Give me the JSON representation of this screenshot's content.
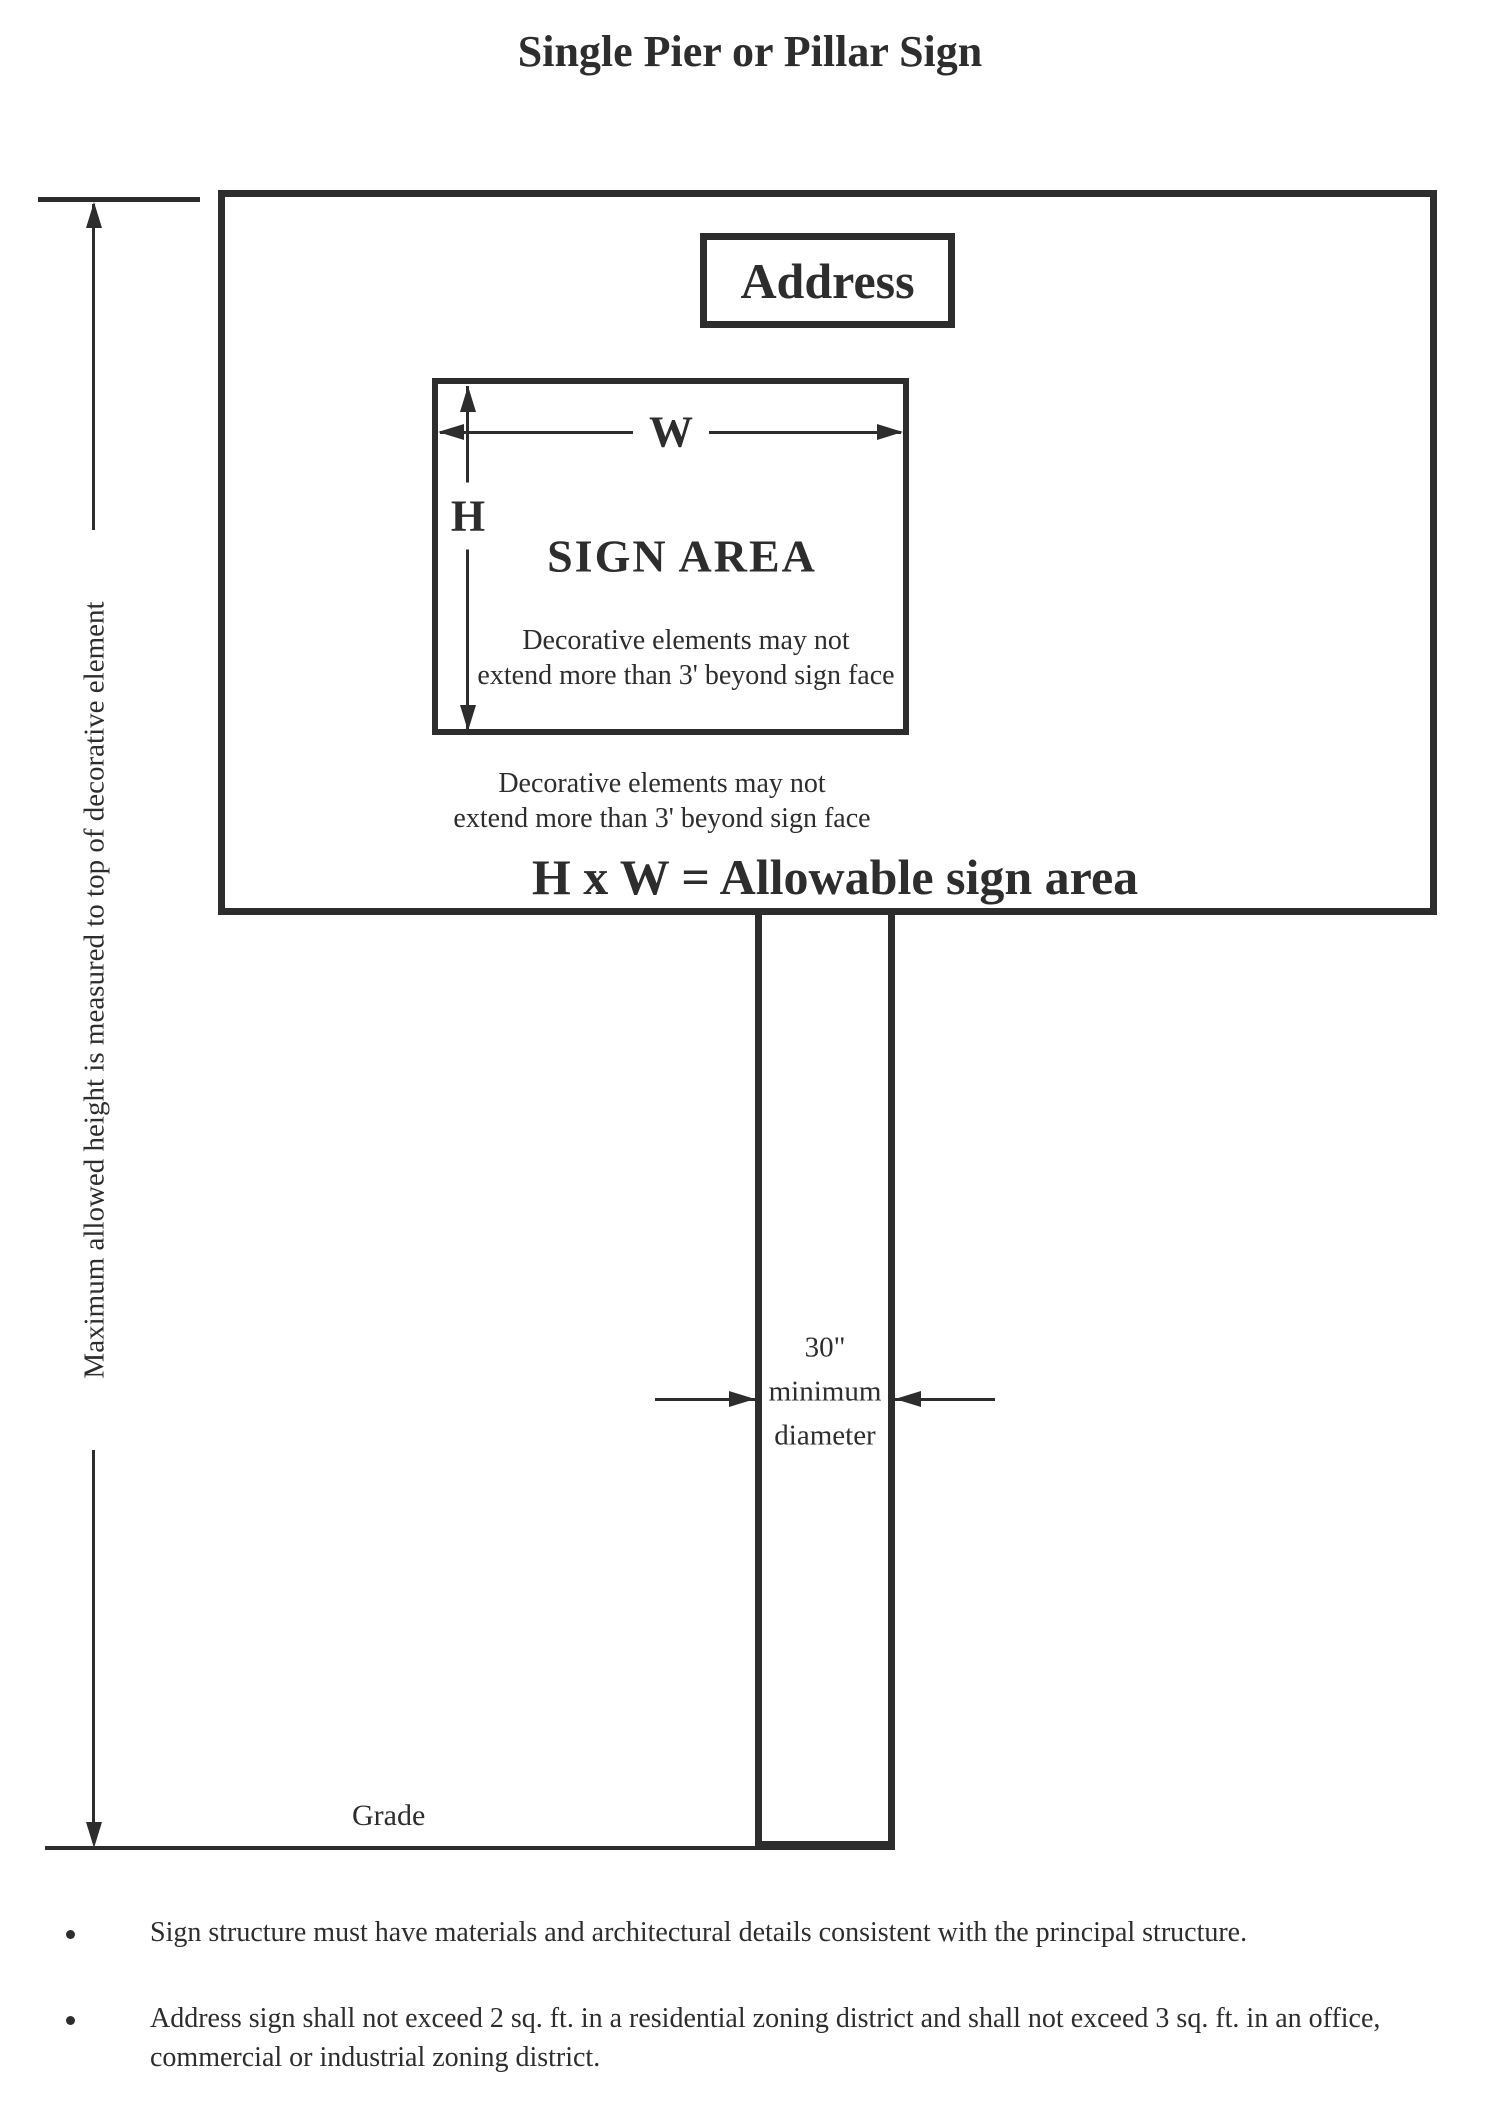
{
  "page": {
    "title": "Single Pier or Pillar Sign",
    "background": "#ffffff",
    "ink": "#2d2d2d"
  },
  "sign": {
    "address_label": "Address",
    "area_label": "SIGN AREA",
    "width_label": "W",
    "height_label": "H",
    "inner_note_line1": "Decorative elements may not",
    "inner_note_line2": "extend more than 3' beyond sign face",
    "outer_note_line1": "Decorative elements may not",
    "outer_note_line2": "extend more than 3' beyond sign face",
    "formula": "H x W = Allowable sign area"
  },
  "dimensions": {
    "max_height_label": "Maximum allowed height is measured to top of decorative element",
    "pole_diameter_line1": "30\"",
    "pole_diameter_line2": "minimum",
    "pole_diameter_line3": "diameter",
    "grade_label": "Grade"
  },
  "notes": [
    "Sign structure must have materials and architectural details consistent with the principal structure.",
    "Address sign shall not exceed 2 sq. ft. in a residential zoning district and shall not exceed 3 sq. ft. in an office, commercial or industrial zoning district."
  ]
}
